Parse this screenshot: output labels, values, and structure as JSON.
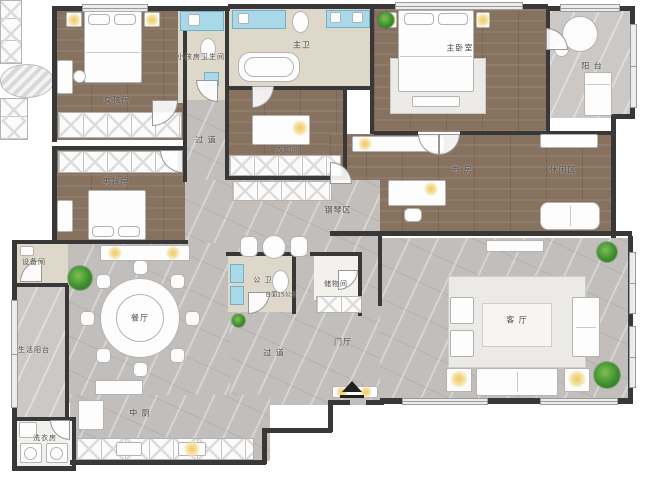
{
  "meta": {
    "type": "residential-floor-plan",
    "language": "zh-CN"
  },
  "colors": {
    "wall": "#383838",
    "wood_floor": "#87715f",
    "marble_floor": "#c1bebb",
    "bath_floor": "#ded8ca",
    "vanity_blue": "#a9d8e8",
    "lamp_glow": "#eec865",
    "plant_green": "#3e8f2e",
    "furniture_white": "#fdfdfd"
  },
  "rooms": [
    {
      "id": "girl-room",
      "label": "女孩房"
    },
    {
      "id": "kids-bathroom",
      "label": "小孩房卫生间"
    },
    {
      "id": "master-bathroom",
      "label": "主卫"
    },
    {
      "id": "master-bedroom",
      "label": "主卧室"
    },
    {
      "id": "balcony",
      "label": "阳 台"
    },
    {
      "id": "hallway-upper",
      "label": "过 道"
    },
    {
      "id": "walk-in-closet",
      "label": "衣帽间"
    },
    {
      "id": "boy-room",
      "label": "男孩房"
    },
    {
      "id": "study",
      "label": "书 房"
    },
    {
      "id": "lounge",
      "label": "休闲区"
    },
    {
      "id": "piano-area",
      "label": "钢琴区"
    },
    {
      "id": "equipment-room",
      "label": "设备间"
    },
    {
      "id": "guest-bathroom",
      "label": "公 卫"
    },
    {
      "id": "storage-room",
      "label": "储物间"
    },
    {
      "id": "dining-room",
      "label": "餐厅"
    },
    {
      "id": "living-room",
      "label": "客 厅"
    },
    {
      "id": "service-balcony",
      "label": "生活阳台"
    },
    {
      "id": "hallway-lower",
      "label": "过 道"
    },
    {
      "id": "foyer",
      "label": "门厅"
    },
    {
      "id": "kitchen",
      "label": "中 厨"
    },
    {
      "id": "laundry-room",
      "label": "洗衣房"
    }
  ],
  "notes": {
    "vanity_note": "台面15公分"
  },
  "icons": {
    "entry_marker": "entry-arrow",
    "plant": "potted-plant-icon",
    "lamp": "ceiling-lamp-glow"
  }
}
